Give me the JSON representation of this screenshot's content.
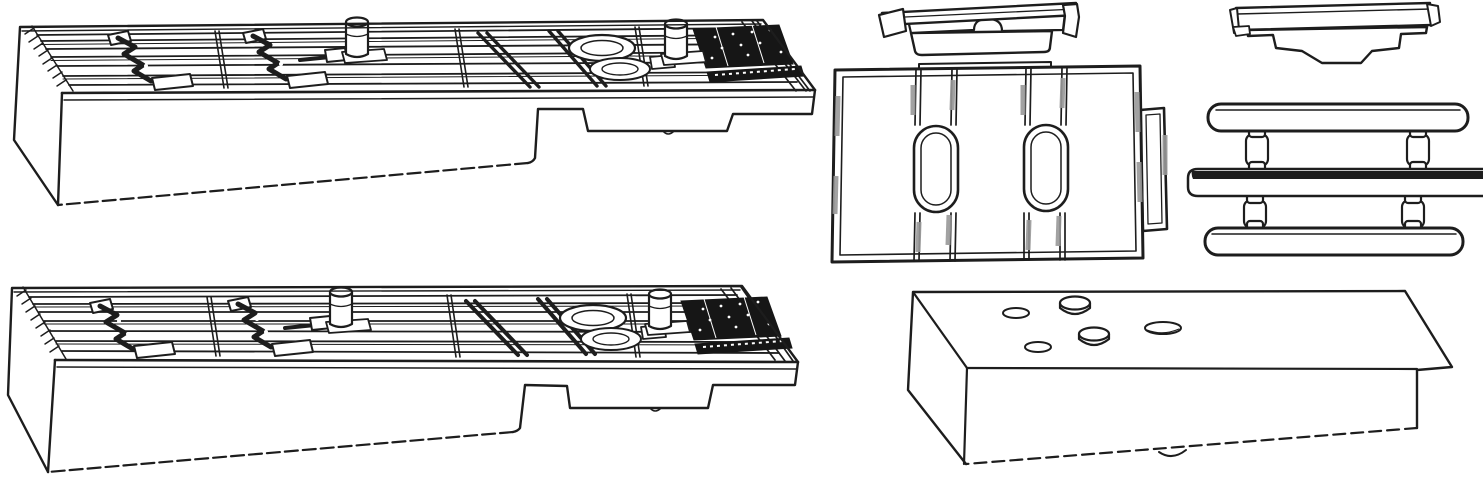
{
  "figure": {
    "type": "technical line drawing",
    "description": "Black-and-white exploded parts diagram of seven molded components on a plain white background; no text, axes or UI controls are present in the image"
  },
  "canvas": {
    "width": 1483,
    "height": 480,
    "background": "#ffffff"
  },
  "colors": {
    "line": "#1d1d1d",
    "shade_gray": "#989898",
    "pad_black": "#161616",
    "fill": "#ffffff"
  },
  "parts": [
    {
      "id": "upper-ribbed-wedge-plate",
      "label": "Ribbed wedge base plate, upper left, isometric view with two spring clips, two cylindrical posts, diagonal braces and a black textured grip pad at the right end"
    },
    {
      "id": "lower-ribbed-wedge-plate",
      "label": "Ribbed wedge base plate, lower left, near-identical duplicate of the upper plate"
    },
    {
      "id": "arch-notch-cap",
      "label": "Small stepped cap with an arched notch, top middle"
    },
    {
      "id": "zigzag-skirt-cap",
      "label": "Small cap with a stepped zigzag skirt, top right"
    },
    {
      "id": "slotted-adapter-plate",
      "label": "Flat adapter plate with two oval slots, double ribs and a side tab, middle"
    },
    {
      "id": "pin-rail-sprue",
      "label": "Three horizontal rails joined by four small pins, right side; middle rail runs off the right edge"
    },
    {
      "id": "boss-wedge-block",
      "label": "Plain wedge spacer block with two round bosses, oval holes and an overhanging lip, bottom right"
    }
  ]
}
